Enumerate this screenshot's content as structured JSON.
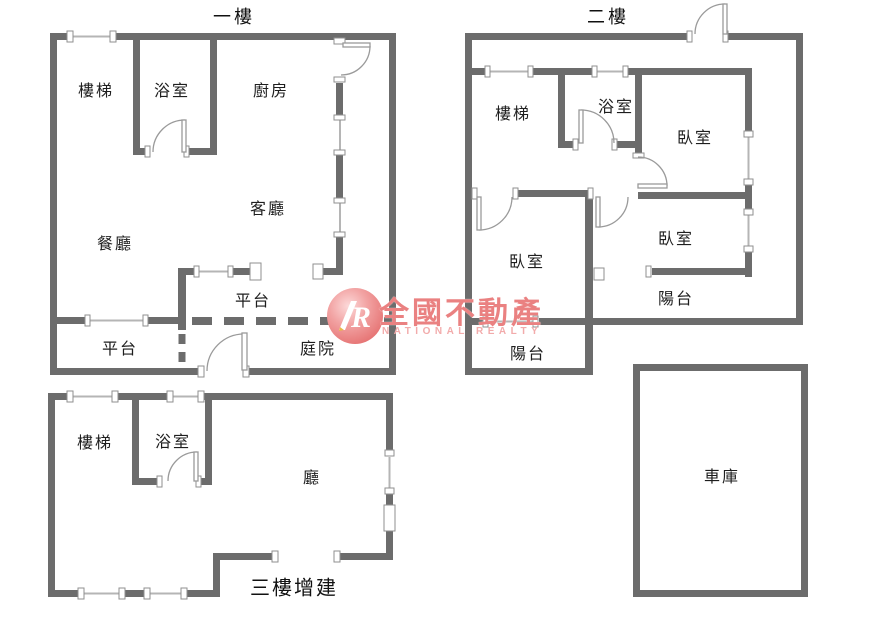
{
  "palette": {
    "wall": "#6c6c6c",
    "window_line": "#b5b5b5",
    "door_arc": "#9a9a9a",
    "jamb_stroke": "#8f8f8f",
    "label_color": "#1e1e1e",
    "logo_brand_color": "#ea8181",
    "logo_tagline_color": "#f2abab",
    "logo_circle_color": "#ec8a8a"
  },
  "floors": {
    "floor1": {
      "title": "一樓",
      "rooms": {
        "stairs": "樓梯",
        "bathroom": "浴室",
        "kitchen": "廚房",
        "living_room": "客廳",
        "dining_room": "餐廳",
        "platform_upper": "平台",
        "platform_lower": "平台",
        "courtyard": "庭院"
      }
    },
    "floor2": {
      "title": "二樓",
      "rooms": {
        "stairs": "樓梯",
        "bathroom": "浴室",
        "bedroom_top": "臥室",
        "bedroom_left": "臥室",
        "bedroom_right": "臥室",
        "balcony_right": "陽台",
        "balcony_left": "陽台"
      }
    },
    "floor3": {
      "title": "三樓增建",
      "rooms": {
        "stairs": "樓梯",
        "bathroom": "浴室",
        "hall": "廳"
      }
    },
    "garage": {
      "label": "車庫"
    }
  },
  "logo": {
    "brand": "全國不動產",
    "tagline": "NATIONAL REALTY",
    "monogram": "R"
  }
}
